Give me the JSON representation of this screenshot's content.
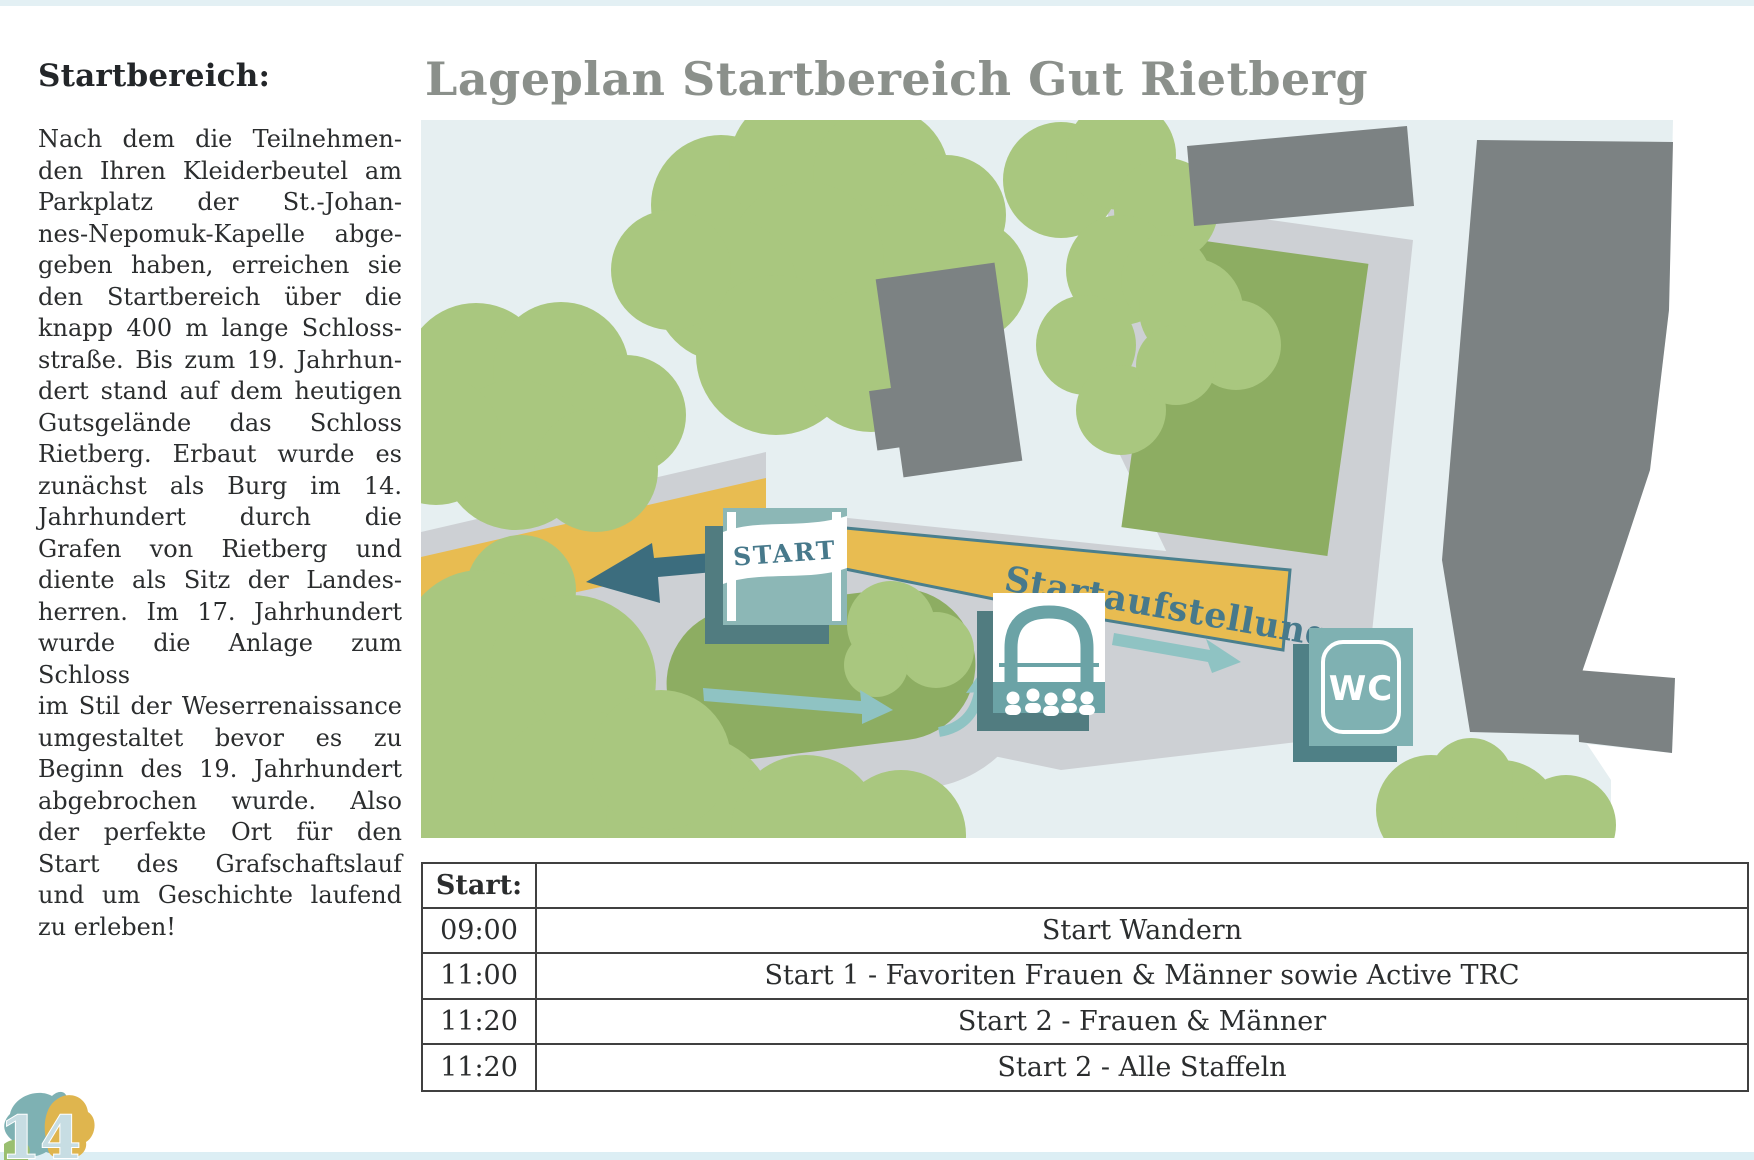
{
  "page": {
    "number": "14",
    "colors": {
      "page_bg": "#ffffff",
      "edge_strip": "#e3f0f4",
      "title_gray": "#8b908b",
      "text_dark": "#2b2d2e",
      "map_bg": "#e6eff1",
      "road_gray": "#cdd0d4",
      "building_gray": "#7c8283",
      "tree_green": "#a9c77f",
      "lawn_green": "#8dad62",
      "band_yellow": "#e8bc51",
      "teal_dark": "#47798b",
      "teal_icon": "#8cb7b6",
      "teal_shadow": "#517c80",
      "arrow_dark": "#3c6d7e",
      "arrow_light": "#8fc3c3"
    }
  },
  "left_column": {
    "heading": "Startbereich:",
    "lines": [
      "Nach dem die Teilnehmen-",
      "den Ihren Kleiderbeutel am",
      "Parkplatz der St.-Johan-",
      "nes-Nepomuk-Kapelle abge-",
      "geben haben, erreichen sie",
      "den Startbereich über die",
      "knapp 400 m lange Schloss-",
      "straße. Bis zum 19. Jahrhun-",
      "dert stand auf dem heutigen",
      "Gutsgelände das Schloss",
      "Rietberg. Erbaut wurde es",
      "zunächst als Burg im 14.",
      "Jahrhundert durch die",
      "Grafen von Rietberg und",
      "diente als Sitz der Landes-",
      "herren. Im 17. Jahrhundert",
      "wurde die Anlage zum Schloss",
      "im Stil der Weserrenaissance",
      "umgestaltet bevor es zu",
      "Beginn des 19. Jahrhundert",
      "abgebrochen wurde. Also",
      "der perfekte Ort für den",
      "Start des Grafschaftslauf",
      "und um Geschichte laufend",
      "zu erleben!"
    ]
  },
  "map": {
    "title": "Lageplan Startbereich Gut Rietberg",
    "labels": {
      "start_sign": "START",
      "startaufstellung": "Startaufstellung",
      "wc": "WC"
    }
  },
  "table": {
    "header": "Start:",
    "rows": [
      [
        "09:00",
        "Start Wandern"
      ],
      [
        "11:00",
        "Start 1 - Favoriten Frauen & Männer sowie Active TRC"
      ],
      [
        "11:20",
        "Start 2 - Frauen & Männer"
      ],
      [
        "11:20",
        "Start 2 - Alle Staffeln"
      ]
    ]
  }
}
